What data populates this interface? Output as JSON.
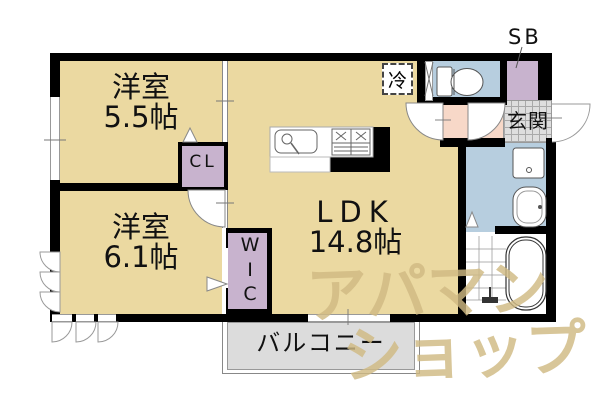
{
  "plan": {
    "rooms": {
      "bedroom_a": {
        "name": "洋室",
        "size": "5.5帖"
      },
      "bedroom_b": {
        "name": "洋室",
        "size": "6.1帖"
      },
      "ldk": {
        "name": "LDK",
        "size": "14.8帖"
      },
      "closet": {
        "label": "CL"
      },
      "walk_in_closet": {
        "chars": [
          "W",
          "I",
          "C"
        ]
      },
      "balcony": {
        "label": "バルコニー"
      },
      "entrance": {
        "label": "玄関"
      },
      "shoe_box_label": "SB",
      "refrigerator_label": "冷"
    },
    "watermark": {
      "line1": "アパマン",
      "line2": "ショップ"
    },
    "colors": {
      "room_tan": "#EBD9A1",
      "closet_purple": "#C8B3CE",
      "wet_area_blue": "#B7CEDF",
      "hallway_pink": "#F7D8C8",
      "entrance_tile_gray": "#DEDEDE",
      "balcony_gray": "#DCDCDC",
      "wall_black": "#000000",
      "watermark_tan": "#CFBA83"
    }
  }
}
